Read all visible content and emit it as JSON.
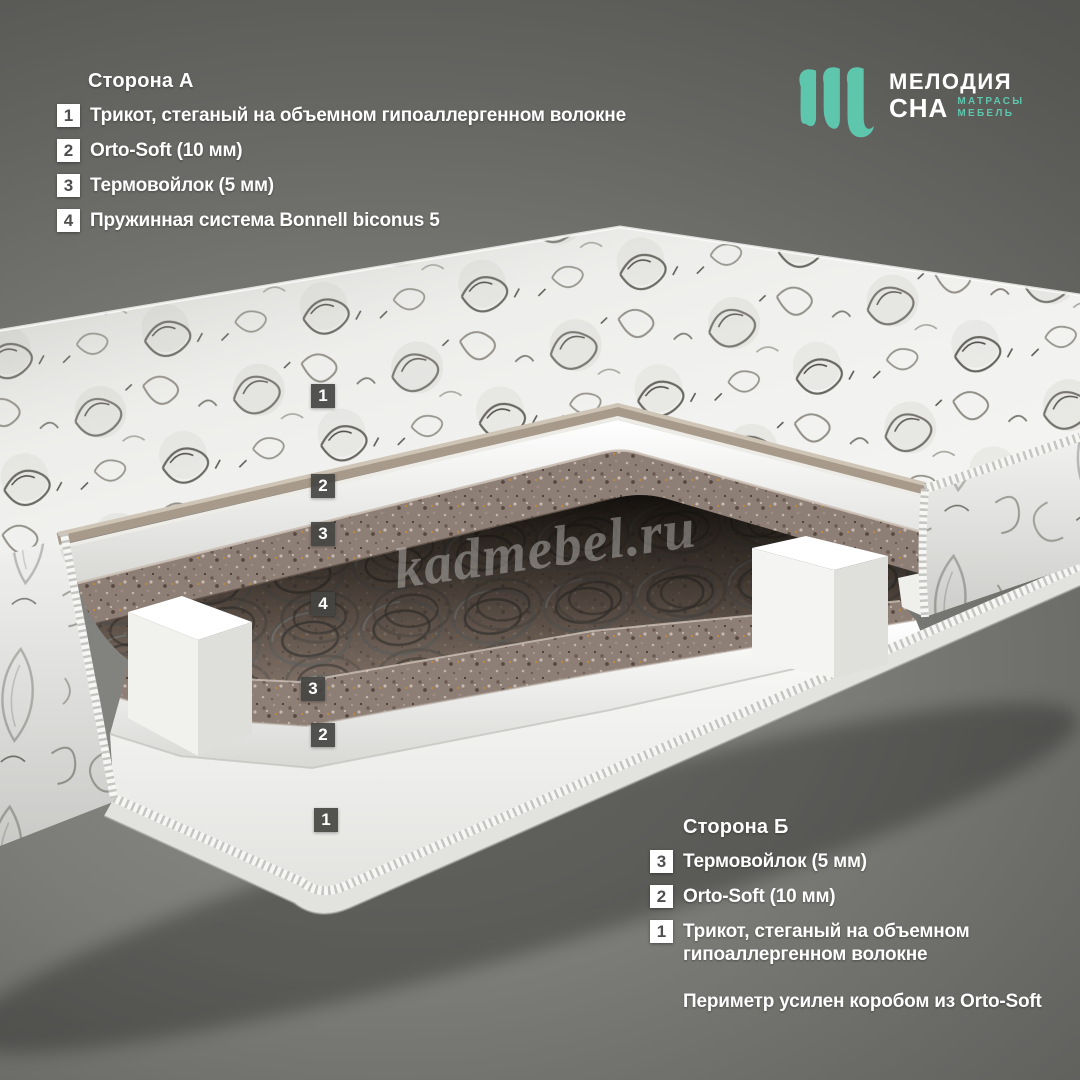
{
  "page": {
    "bg_center_color": "#8d8d89",
    "bg_edge_color": "#4b4b49"
  },
  "logo": {
    "mark_icon": "melodia-sna-m-mark",
    "line1": "МЕЛОДИЯ",
    "line2": "СНА",
    "tag1": "МАТРАСЫ",
    "tag2": "МЕБЕЛЬ",
    "accent_color": "#5fc6ae"
  },
  "side_a": {
    "title": "Сторона А",
    "items": [
      {
        "num": "1",
        "label": "Трикот, стеганый на объемном гипоаллергенном волокне"
      },
      {
        "num": "2",
        "label": "Orto-Soft (10 мм)"
      },
      {
        "num": "3",
        "label": "Термовойлок (5 мм)"
      },
      {
        "num": "4",
        "label": "Пружинная система Bonnell biconus 5"
      }
    ]
  },
  "side_b": {
    "title": "Сторона Б",
    "items": [
      {
        "num": "3",
        "label": "Термовойлок (5 мм)"
      },
      {
        "num": "2",
        "label": "Orto-Soft (10 мм)"
      },
      {
        "num": "1",
        "label": "Трикот, стеганый на объемном гипоаллергенном волокне"
      }
    ],
    "note": "Периметр усилен коробом из Orto-Soft"
  },
  "mattress": {
    "layer_badges": [
      "1",
      "2",
      "3",
      "4",
      "3",
      "2",
      "1"
    ]
  },
  "watermark": {
    "text": "kadmebel.ru"
  }
}
